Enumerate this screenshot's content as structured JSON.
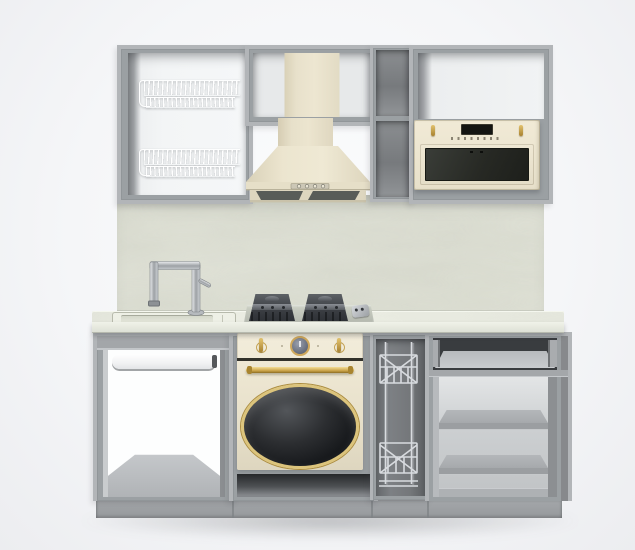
{
  "scene": {
    "description": "3D product render of a modular kitchen set, front view, no doors on carcasses",
    "background_color": "#f5f6f8",
    "palette": {
      "cabinet_gray": "#9ba0a3",
      "cabinet_edge_light": "#b2b5b8",
      "cabinet_side_dark": "#87898c",
      "interior_white": "#f3f5f6",
      "interior_dark": "#777a7d",
      "appliance_cream": "#ece5d0",
      "appliance_cream_shadow": "#ded6bf",
      "brass_gold": "#c79f45",
      "glass_dark": "#232521",
      "chrome": "#c6cacf",
      "backsplash_stone": "#dadcd0",
      "countertop_stone": "#e8eae0",
      "burner_dark": "#3c3f44",
      "plinth_gray": "#9ea1a4"
    },
    "upper_row": {
      "left_cabinet": {
        "name": "open wall cabinet with two wire dish-drying racks",
        "racks": 2
      },
      "hood_cabinet": {
        "name": "open wall cabinet housing the hood chimney"
      },
      "hood": {
        "name": "cream pyramid chimney cooker hood",
        "buttons": 4,
        "grease_filters": 2
      },
      "shelf_column": {
        "name": "narrow open shelf column",
        "compartments": 2
      },
      "microwave_cabinet": {
        "name": "open wall cabinet with built-in microwave"
      },
      "microwave": {
        "name": "cream retro built-in microwave",
        "display": "black LCD",
        "knobs": 2,
        "buttons": 8
      }
    },
    "mid_section": {
      "backsplash": {
        "name": "light green-grey stone backsplash"
      },
      "countertop": {
        "name": "light stone worktop"
      },
      "sink": {
        "name": "inset single-bowl sink"
      },
      "faucet": {
        "name": "stainless steel L-shaped mixer tap"
      },
      "hob": {
        "name": "two-burner built-in gas hob",
        "burners": 2,
        "control": "side knob unit"
      }
    },
    "base_row": {
      "sink_cabinet": {
        "name": "open sink base cabinet with white towel rail"
      },
      "oven_cabinet": {
        "name": "base cabinet with retro cream oven"
      },
      "oven": {
        "name": "cream retro oven",
        "knobs": 2,
        "clock": 1,
        "handle": "brass bar",
        "window": "oval dark glass with gold trim"
      },
      "cargo_cabinet": {
        "name": "narrow pull-out chrome wire cargo basket",
        "tiers": 2
      },
      "shelf_cabinet": {
        "name": "open base cabinet with top drawer and two shelves",
        "drawers": 1,
        "shelves": 2
      },
      "plinth": {
        "name": "grey toe-kick plinth",
        "sections": 4
      }
    }
  }
}
